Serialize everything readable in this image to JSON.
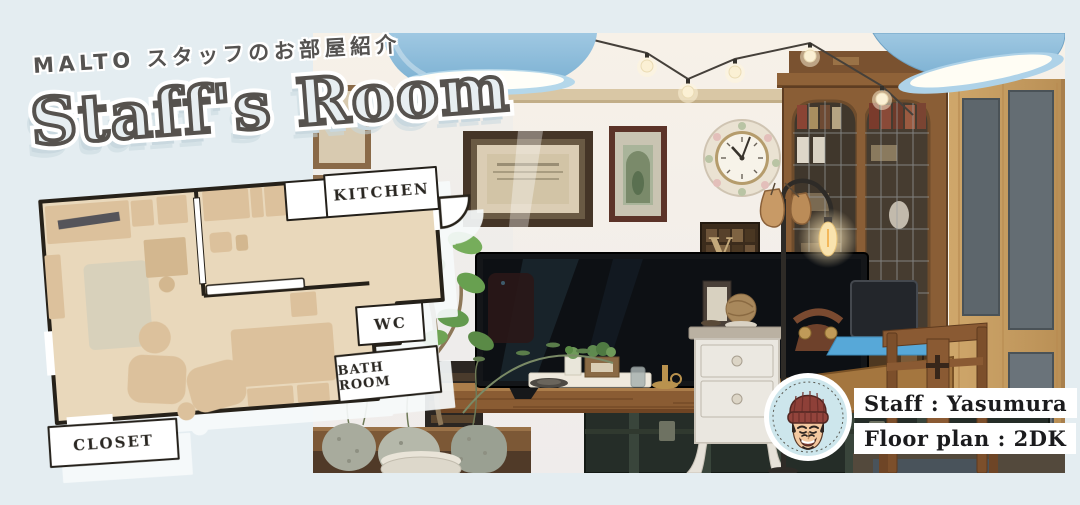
{
  "canvas": {
    "width": 1080,
    "height": 505,
    "background_color": "#e4edf1"
  },
  "header": {
    "tagline": "MALTO スタッフのお部屋紹介",
    "title": "Staff's Room",
    "title_color": "#56524e",
    "title_shadow_color": "#c9d8df"
  },
  "floor_plan": {
    "labels": {
      "kitchen": "KITCHEN",
      "wc": "WC",
      "bath_room": "BATH ROOM",
      "closet": "CLOSET"
    },
    "colors": {
      "floor": "#e9d8bb",
      "furniture": "#dcc19c",
      "walls": "#262119",
      "label_background": "#ffffff"
    }
  },
  "staff_card": {
    "staff_line": "Staff : Yasumura",
    "floor_plan_line": "Floor plan : 2DK"
  },
  "avatar": {
    "beanie_color": "#8e4038",
    "background_color": "#cde6ec"
  },
  "photo": {
    "letterpress_letter": "V",
    "pendant_lamp_color": "#8cbcd9"
  }
}
